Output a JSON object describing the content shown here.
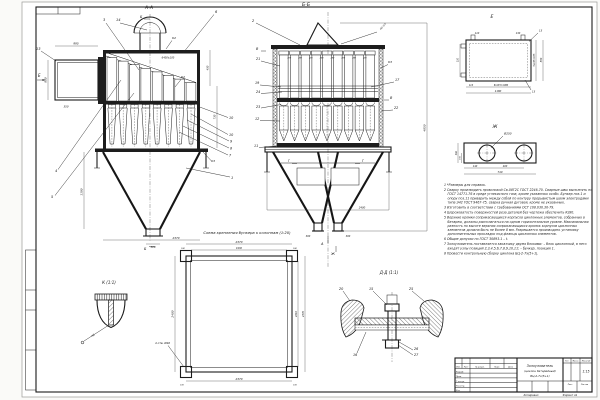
{
  "aa": {
    "title": "А-А",
    "mark_top": "Б",
    "mark_bottom": "Б",
    "view_e": "Е",
    "c1": "1",
    "c3": "3",
    "c4": "4",
    "c5": "5",
    "c6": "6",
    "c13": "13",
    "c14": "14",
    "stack": [
      "10",
      "10",
      "9",
      "8",
      "7"
    ],
    "k2": "К2",
    "k3": "К3",
    "d995": "995",
    "d800": "800",
    "d350": "350",
    "d1190": "1190",
    "d450": "450",
    "d730": "730",
    "d6400": "6400±100",
    "d2370": "2370",
    "d300": "300"
  },
  "bb": {
    "title": "Б-Б",
    "pitch": "280",
    "d4850": "4850",
    "d2400": "2400",
    "d300": "300",
    "left": [
      "2",
      "21",
      "19",
      "24",
      "23",
      "12",
      "11"
    ],
    "c17": "17",
    "c22": "22",
    "k3": "К3",
    "weld": "Н1-3,4",
    "mv": "В",
    "mg": "Г",
    "ma": "А",
    "mj": "Ж"
  },
  "de": {
    "title": "Е",
    "d110a": "110",
    "d130": "130",
    "d110b": "110",
    "d110c": "110",
    "d675": "5х135=675",
    "d880": "880",
    "d1080": "8х135=1080",
    "d1180": "1180",
    "h13": "13"
  },
  "dj": {
    "title": "Ж",
    "hole": "Ø250",
    "d140": "140",
    "d400": "400",
    "d740": "740",
    "d300": "300",
    "d150": "150"
  },
  "sc": {
    "title": "Схема крепления бункера к колоннам (1:20)",
    "d2370t": "2370",
    "d1930": "1930",
    "d180": "180",
    "d2400": "2400",
    "d2210": "2210",
    "d2370r": "2370",
    "d2370b": "2370",
    "d100": "100",
    "holes": "4 отв. Ø40"
  },
  "dk": {
    "title": "К (1:1)",
    "weld": "Н2"
  },
  "dd": {
    "title": "Д-Д (1:1)",
    "c20": "20",
    "c15": "15",
    "c25": "25",
    "c16": "16",
    "c26": "26",
    "c27": "27"
  },
  "notes": {
    "items": [
      "1 *Размеры для справок.",
      "2 Сварку производить проволокой Св-08Г2С ГОСТ 2246-70. Сварные швы выполнять по ГОСТ 14771-76 в среде углекислого газа, кроме указанных особо. Бункер поз.1 и опору поз.11 приварить между собой по контуру прерывистым швом электродами типа Э42 ГОСТ 9467-75, сварка ручная дуговая, кроме не указанных.",
      "3 Изготовить в соответствии с требованиями ОСТ 108.030.30-79.",
      "4 Шероховатость поверхностей реза деталей без чертежа обеспечить Rz80.",
      "5 Верхние кромки соприкасающихся корпусов циклонных элементов, собранных в батарею, должны располагаться на одном горизонтальном уровне. Максимальная разность по высоте верхних соприкасающихся кромок корпусов циклонных элементов должна быть не более 8 мм. Разрешается производить установку дополнительных прокладок под фланцы циклонных элементов.",
      "6 Общие допуски по ГОСТ 30893.1 – t.",
      "7 Золоуловитель поставляется заказчику двумя блоками: – блок циклонный, в него входят узлы позиций 2,3,4,5,6,7,8,9,10,11; – бункер, позиция 1.",
      "8 Провести контрольную сборку циклона БЦ-2-7х(5+1)."
    ]
  },
  "tb": {
    "name1": "Золоуловитель",
    "name2": "(циклон батарейный)",
    "name3": "БЦ-2-7х(5+1)",
    "scale": "1:15",
    "izm": "Изм.",
    "list": "Лист",
    "dokum": "№ докум.",
    "podp": "Подп.",
    "data": "Дата",
    "razrab": "Разраб.",
    "prov": "Пров.",
    "tkontr": "Т.контр.",
    "nkontr": "Н.контр.",
    "utv": "Утв.",
    "lit": "Лит.",
    "massa": "Масса",
    "masshtab": "Масштаб",
    "list2": "Лист",
    "listov": "Листов",
    "kopiroval": "Копировал",
    "format": "Формат A1"
  }
}
